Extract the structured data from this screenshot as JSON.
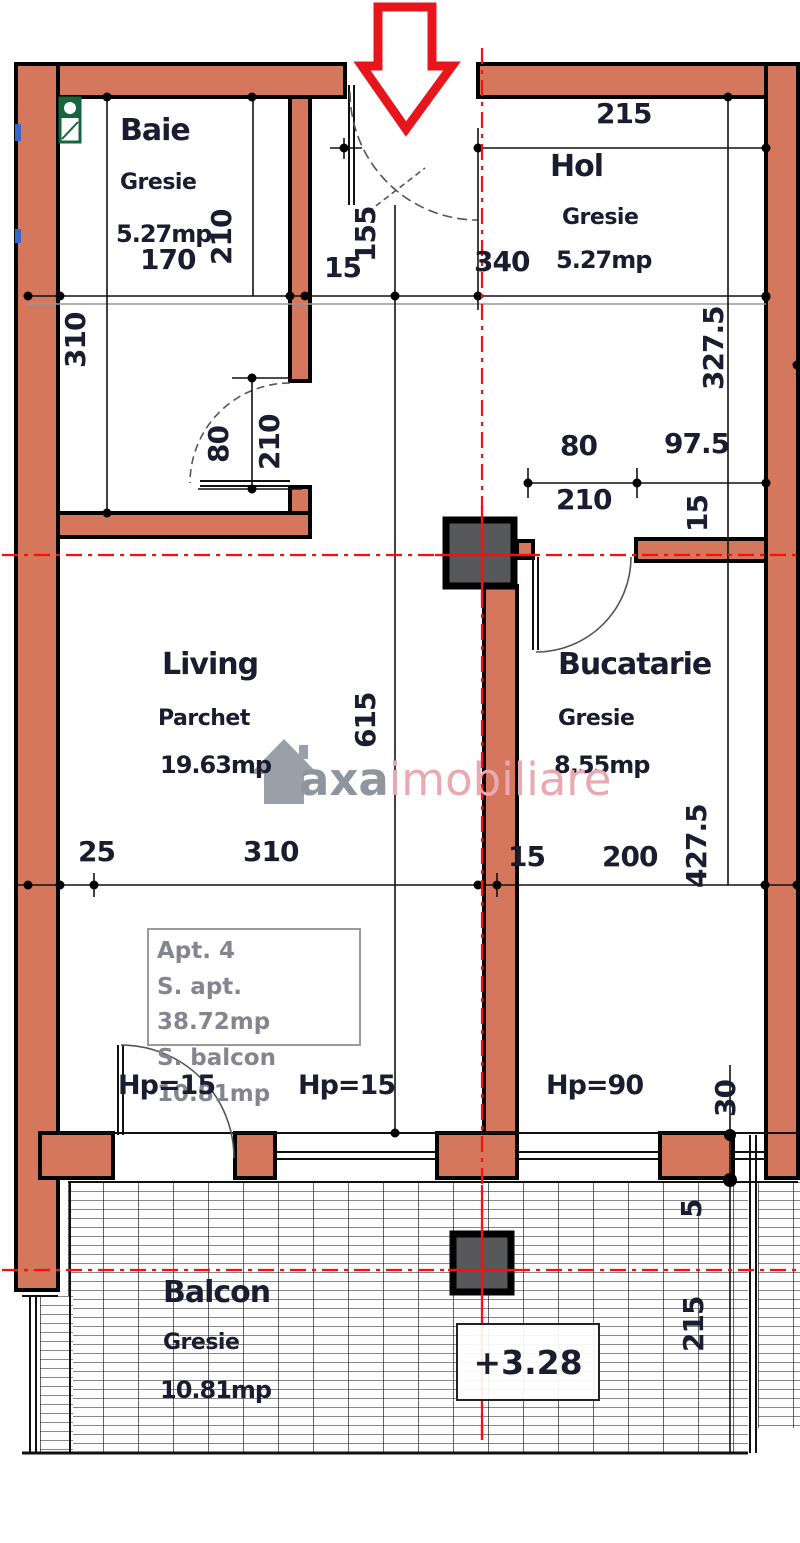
{
  "rooms": {
    "baie": {
      "name": "Baie",
      "floor": "Gresie",
      "area": "5.27mp"
    },
    "hol": {
      "name": "Hol",
      "floor": "Gresie",
      "area": "5.27mp"
    },
    "living": {
      "name": "Living",
      "floor": "Parchet",
      "area": "19.63mp"
    },
    "bucatarie": {
      "name": "Bucatarie",
      "floor": "Gresie",
      "area": "8.55mp"
    },
    "balcon": {
      "name": "Balcon",
      "floor": "Gresie",
      "area": "10.81mp"
    }
  },
  "dims": {
    "d170": "170",
    "d210_baie": "210",
    "d310_baie": "310",
    "d155": "155",
    "d15_entry": "15",
    "d340": "340",
    "d215_hol": "215",
    "d327_5": "327.5",
    "d80_baie_door": "80",
    "d210_baie_door": "210",
    "d80_hol": "80",
    "d97_5": "97.5",
    "d210_hol": "210",
    "d15_hol": "15",
    "d615": "615",
    "d25": "25",
    "d310_living": "310",
    "d15_bottom": "15",
    "d200": "200",
    "d427_5": "427.5",
    "hp15_a": "Hp=15",
    "hp15_b": "Hp=15",
    "hp90": "Hp=90",
    "d30": "30",
    "d5": "5",
    "d215_balcony": "215"
  },
  "info_box": {
    "line1": "Apt. 4",
    "line2": "S. apt. 38.72mp",
    "line3": "S. balcon 10.81mp"
  },
  "elevation": {
    "value": "+3.28"
  },
  "watermark": {
    "brand": "axa",
    "brand2": "imobiliare"
  },
  "colors": {
    "wall": "#d4775c",
    "axis": "#fb0f0c",
    "arrow": "#e8151d",
    "pillar": "#56585a",
    "dim_text": "#1c1c30",
    "watermark_gray": "#8f959c",
    "watermark_pink": "#eaa9b0",
    "info_text": "#85858f",
    "fixture_green": "#15663a"
  }
}
